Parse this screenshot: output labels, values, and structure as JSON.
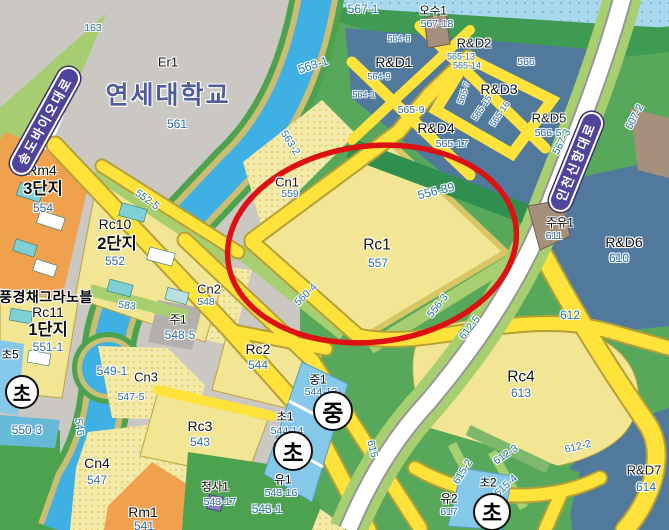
{
  "palette": {
    "highlight_red": "#dd1111",
    "road_yellow": "#ffe23a",
    "road_badge_purple": "#4f449b",
    "water_blue": "#3fb0e4",
    "sea_blue": "#a9d7ee",
    "rnd_slate": "#51799c",
    "parcel_yellow": "#f2e593",
    "residential_orange": "#f0a14e",
    "park_green": "#58a85c",
    "school_blue": "#85c8e9",
    "parcel_number_blue": "#2e6fae"
  },
  "map": {
    "university": {
      "code": "Er1",
      "name": "연세대학교",
      "parcel": "561"
    },
    "road_badges": [
      {
        "id": "road-badge-songdo-bio-daero",
        "name": "송도바이오대로",
        "x": 45,
        "y": 121,
        "rot": -61
      },
      {
        "id": "road-badge-incheon-sinhang-daero",
        "name": "인천신항대로",
        "x": 576,
        "y": 162,
        "rot": -68
      }
    ],
    "circle_badges": [
      {
        "id": "school-badge-elementary-left",
        "text": "초",
        "x": 22,
        "y": 392,
        "d": 34
      },
      {
        "id": "school-badge-middle",
        "text": "중",
        "x": 333,
        "y": 411,
        "d": 40
      },
      {
        "id": "school-badge-elementary-center",
        "text": "초",
        "x": 293,
        "y": 451,
        "d": 40
      },
      {
        "id": "school-badge-elementary-southeast",
        "text": "초",
        "x": 492,
        "y": 512,
        "d": 38
      }
    ],
    "labels": [
      {
        "id": "zone-er1",
        "text": "Er1",
        "x": 168,
        "y": 62,
        "cls": "z13"
      },
      {
        "id": "university-name",
        "text": "연세대학교",
        "x": 168,
        "y": 96,
        "cls": "uni"
      },
      {
        "id": "parcel-561",
        "text": "561",
        "x": 177,
        "y": 124,
        "cls": "num12"
      },
      {
        "id": "parcel-163",
        "text": "163",
        "x": 93,
        "y": 28,
        "cls": "gnum"
      },
      {
        "id": "parcel-567-1",
        "text": "567-1",
        "x": 363,
        "y": 9,
        "cls": "gnum12"
      },
      {
        "id": "fac-osu1",
        "text": "오수1",
        "x": 433,
        "y": 12,
        "cls": "fac"
      },
      {
        "id": "parcel-567-18",
        "text": "567-18",
        "x": 437,
        "y": 24,
        "cls": "num"
      },
      {
        "id": "zone-rnd1",
        "text": "R&D1",
        "x": 394,
        "y": 62,
        "cls": "z14"
      },
      {
        "id": "zone-rnd2",
        "text": "R&D2",
        "x": 474,
        "y": 43,
        "cls": "z13"
      },
      {
        "id": "zone-rnd3",
        "text": "R&D3",
        "x": 499,
        "y": 89,
        "cls": "z14"
      },
      {
        "id": "zone-rnd4",
        "text": "R&D4",
        "x": 436,
        "y": 128,
        "cls": "z14"
      },
      {
        "id": "zone-rnd5",
        "text": "R&D5",
        "x": 549,
        "y": 118,
        "cls": "z13"
      },
      {
        "id": "parcel-564-8",
        "text": "564-8",
        "x": 399,
        "y": 39,
        "cls": "numS"
      },
      {
        "id": "parcel-564-9",
        "text": "564-9",
        "x": 379,
        "y": 77,
        "cls": "numS"
      },
      {
        "id": "parcel-564-1",
        "text": "564-1",
        "x": 364,
        "y": 95,
        "cls": "numS"
      },
      {
        "id": "parcel-565-9",
        "text": "565-9",
        "x": 411,
        "y": 110,
        "cls": "num"
      },
      {
        "id": "parcel-565-17",
        "text": "565-17",
        "x": 452,
        "y": 144,
        "cls": "num"
      },
      {
        "id": "parcel-565-7",
        "text": "565-7",
        "x": 464,
        "y": 93,
        "cls": "numS",
        "rot": -72
      },
      {
        "id": "parcel-565-15",
        "text": "565-15",
        "x": 482,
        "y": 108,
        "cls": "numS",
        "rot": -56
      },
      {
        "id": "parcel-565-16",
        "text": "565-16",
        "x": 500,
        "y": 114,
        "cls": "numS",
        "rot": -56
      },
      {
        "id": "parcel-565-13",
        "text": "565-13",
        "x": 461,
        "y": 57,
        "cls": "numS"
      },
      {
        "id": "parcel-565-14",
        "text": "565-14",
        "x": 467,
        "y": 66,
        "cls": "numS"
      },
      {
        "id": "parcel-566",
        "text": "566",
        "x": 526,
        "y": 62,
        "cls": "num"
      },
      {
        "id": "parcel-566-5",
        "text": "566-5",
        "x": 548,
        "y": 133,
        "cls": "num"
      },
      {
        "id": "parcel-567-3",
        "text": "567-3",
        "x": 562,
        "y": 142,
        "cls": "gnum",
        "rot": -62
      },
      {
        "id": "parcel-607-2",
        "text": "607-2",
        "x": 635,
        "y": 117,
        "cls": "gnum",
        "rot": -62
      },
      {
        "id": "fac-juyu1",
        "text": "주유1",
        "x": 560,
        "y": 224,
        "cls": "fac"
      },
      {
        "id": "parcel-611",
        "text": "611",
        "x": 554,
        "y": 236,
        "cls": "num"
      },
      {
        "id": "zone-rnd6",
        "text": "R&D6",
        "x": 624,
        "y": 242,
        "cls": "z14"
      },
      {
        "id": "parcel-610",
        "text": "610",
        "x": 619,
        "y": 258,
        "cls": "num12"
      },
      {
        "id": "parcel-612",
        "text": "612",
        "x": 570,
        "y": 315,
        "cls": "gnum12"
      },
      {
        "id": "parcel-563-1",
        "text": "563-1",
        "x": 313,
        "y": 65,
        "cls": "gnum12",
        "rot": -18
      },
      {
        "id": "parcel-563-2",
        "text": "563-2",
        "x": 290,
        "y": 143,
        "cls": "gnum",
        "rot": 58
      },
      {
        "id": "zone-cn1",
        "text": "Cn1",
        "x": 287,
        "y": 182,
        "cls": "z13"
      },
      {
        "id": "parcel-559",
        "text": "559",
        "x": 290,
        "y": 194,
        "cls": "num"
      },
      {
        "id": "zone-rc1",
        "text": "Rc1",
        "x": 377,
        "y": 245,
        "cls": "z15"
      },
      {
        "id": "parcel-557",
        "text": "557",
        "x": 378,
        "y": 263,
        "cls": "num12"
      },
      {
        "id": "parcel-556-39",
        "text": "556-39",
        "x": 436,
        "y": 191,
        "cls": "gnum12",
        "rot": -14
      },
      {
        "id": "parcel-560-4",
        "text": "560-4",
        "x": 306,
        "y": 295,
        "cls": "gnum",
        "rot": -44
      },
      {
        "id": "parcel-556-3",
        "text": "556-3",
        "x": 438,
        "y": 306,
        "cls": "gnum",
        "rot": -52
      },
      {
        "id": "parcel-612-5",
        "text": "612-5",
        "x": 470,
        "y": 328,
        "cls": "gnum",
        "rot": -52
      },
      {
        "id": "zone-rm4",
        "text": "Rm4",
        "x": 42,
        "y": 170,
        "cls": "z14"
      },
      {
        "id": "complex-3danji",
        "text": "3단지",
        "x": 43,
        "y": 189,
        "cls": "kb"
      },
      {
        "id": "parcel-554",
        "text": "554",
        "x": 43,
        "y": 208,
        "cls": "num12"
      },
      {
        "id": "zone-rc10",
        "text": "Rc10",
        "x": 115,
        "y": 224,
        "cls": "z14"
      },
      {
        "id": "complex-2danji",
        "text": "2단지",
        "x": 117,
        "y": 244,
        "cls": "kb"
      },
      {
        "id": "parcel-552",
        "text": "552",
        "x": 115,
        "y": 261,
        "cls": "num12"
      },
      {
        "id": "parcel-552-5",
        "text": "552-5",
        "x": 147,
        "y": 200,
        "cls": "gnum",
        "rot": 36
      },
      {
        "id": "apt-name",
        "text": "풍경채그라노블",
        "x": 46,
        "y": 297,
        "cls": "ko"
      },
      {
        "id": "zone-rc11",
        "text": "Rc11",
        "x": 48,
        "y": 312,
        "cls": "z14"
      },
      {
        "id": "complex-1danji",
        "text": "1단지",
        "x": 48,
        "y": 330,
        "cls": "kb"
      },
      {
        "id": "parcel-551-1",
        "text": "551-1",
        "x": 48,
        "y": 347,
        "cls": "num12"
      },
      {
        "id": "school-cho5",
        "text": "초5",
        "x": 10,
        "y": 356,
        "cls": "fac"
      },
      {
        "id": "parcel-550-3",
        "text": "550-3",
        "x": 27,
        "y": 430,
        "cls": "num12"
      },
      {
        "id": "parcel-549-1",
        "text": "549-1",
        "x": 112,
        "y": 371,
        "cls": "num12"
      },
      {
        "id": "parcel-583",
        "text": "583",
        "x": 127,
        "y": 306,
        "cls": "gnum",
        "rot": 8
      },
      {
        "id": "zone-cn3",
        "text": "Cn3",
        "x": 146,
        "y": 377,
        "cls": "z13"
      },
      {
        "id": "parcel-547-5",
        "text": "547-5",
        "x": 131,
        "y": 397,
        "cls": "num"
      },
      {
        "id": "zone-cn2",
        "text": "Cn2",
        "x": 209,
        "y": 289,
        "cls": "z13"
      },
      {
        "id": "parcel-548",
        "text": "548",
        "x": 206,
        "y": 302,
        "cls": "num"
      },
      {
        "id": "fac-ju1",
        "text": "주1",
        "x": 178,
        "y": 321,
        "cls": "fac"
      },
      {
        "id": "parcel-548-5",
        "text": "548-5",
        "x": 180,
        "y": 335,
        "cls": "num12"
      },
      {
        "id": "parcel-546",
        "text": "546",
        "x": 79,
        "y": 427,
        "cls": "gnum",
        "rot": 82
      },
      {
        "id": "zone-cn4",
        "text": "Cn4",
        "x": 97,
        "y": 463,
        "cls": "z14"
      },
      {
        "id": "parcel-547",
        "text": "547",
        "x": 97,
        "y": 480,
        "cls": "num12"
      },
      {
        "id": "zone-rm1",
        "text": "Rm1",
        "x": 143,
        "y": 512,
        "cls": "z14"
      },
      {
        "id": "parcel-541",
        "text": "541",
        "x": 144,
        "y": 526,
        "cls": "num12"
      },
      {
        "id": "zone-rc2",
        "text": "Rc2",
        "x": 258,
        "y": 349,
        "cls": "z14"
      },
      {
        "id": "parcel-544",
        "text": "544",
        "x": 258,
        "y": 365,
        "cls": "num12"
      },
      {
        "id": "zone-rc3",
        "text": "Rc3",
        "x": 200,
        "y": 426,
        "cls": "z14"
      },
      {
        "id": "parcel-543",
        "text": "543",
        "x": 200,
        "y": 442,
        "cls": "num12"
      },
      {
        "id": "school-jung1",
        "text": "중1",
        "x": 318,
        "y": 381,
        "cls": "fac"
      },
      {
        "id": "parcel-544-13",
        "text": "544-13",
        "x": 321,
        "y": 392,
        "cls": "num"
      },
      {
        "id": "school-cho1",
        "text": "초1",
        "x": 285,
        "y": 418,
        "cls": "fac"
      },
      {
        "id": "parcel-544-14",
        "text": "544-14",
        "x": 287,
        "y": 431,
        "cls": "num"
      },
      {
        "id": "school-yu1",
        "text": "유1",
        "x": 283,
        "y": 481,
        "cls": "fac"
      },
      {
        "id": "parcel-543-16",
        "text": "543-16",
        "x": 281,
        "y": 493,
        "cls": "num"
      },
      {
        "id": "fac-cheongsa1",
        "text": "청사1",
        "x": 215,
        "y": 488,
        "cls": "fac"
      },
      {
        "id": "parcel-543-17",
        "text": "543-17",
        "x": 220,
        "y": 502,
        "cls": "num"
      },
      {
        "id": "parcel-543-1",
        "text": "543-1",
        "x": 267,
        "y": 509,
        "cls": "gnum12"
      },
      {
        "id": "road-615",
        "text": "615",
        "x": 372,
        "y": 449,
        "cls": "gnum",
        "rot": 76
      },
      {
        "id": "zone-rc4",
        "text": "Rc4",
        "x": 521,
        "y": 377,
        "cls": "z15"
      },
      {
        "id": "parcel-613",
        "text": "613",
        "x": 521,
        "y": 393,
        "cls": "num12"
      },
      {
        "id": "parcel-612-2",
        "text": "612-2",
        "x": 578,
        "y": 447,
        "cls": "gnum",
        "rot": -14
      },
      {
        "id": "parcel-612-3",
        "text": "612-3",
        "x": 506,
        "y": 455,
        "cls": "gnum",
        "rot": -34
      },
      {
        "id": "parcel-615-2",
        "text": "615-2",
        "x": 463,
        "y": 472,
        "cls": "gnum",
        "rot": -58
      },
      {
        "id": "parcel-615-4",
        "text": "615-4",
        "x": 506,
        "y": 486,
        "cls": "gnum",
        "rot": -42
      },
      {
        "id": "school-yu2",
        "text": "유2",
        "x": 449,
        "y": 500,
        "cls": "fac"
      },
      {
        "id": "parcel-617",
        "text": "617",
        "x": 449,
        "y": 512,
        "cls": "num"
      },
      {
        "id": "school-cho2",
        "text": "초2",
        "x": 488,
        "y": 484,
        "cls": "fac"
      },
      {
        "id": "zone-rnd7",
        "text": "R&D7",
        "x": 644,
        "y": 470,
        "cls": "z13"
      },
      {
        "id": "parcel-614",
        "text": "614",
        "x": 646,
        "y": 487,
        "cls": "num12"
      }
    ]
  }
}
